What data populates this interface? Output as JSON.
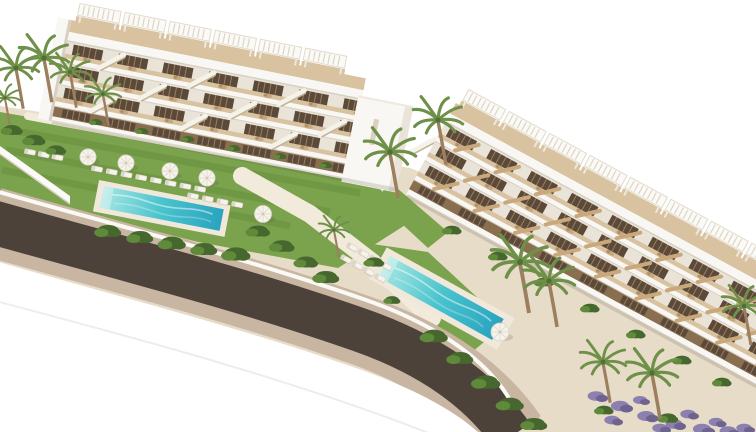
{
  "scene": {
    "description": "Aerial 3D architectural render of a white terraced apartment complex with rooftop pergolas, two turquoise pools, lawns with sun loungers and parasols, palm trees and a curved road in the foreground",
    "background": "white sky",
    "buildings": [
      {
        "name": "left-wing",
        "features": [
          "rooftop-pergolas",
          "stepped-terraces",
          "stairs",
          "round-daybeds",
          "end-tower"
        ]
      },
      {
        "name": "right-wing",
        "features": [
          "rooftop-pergolas",
          "stepped-units-descending-right",
          "wood-ladder-stairs",
          "round-daybeds"
        ]
      }
    ],
    "pools": [
      {
        "name": "main-pool",
        "shape": "long-rectangle"
      },
      {
        "name": "second-pool",
        "shape": "long-rectangle"
      }
    ],
    "road": {
      "name": "curved-asphalt-road",
      "edges": "beige-sidewalks"
    },
    "vegetation": [
      "palm-trees",
      "hedges",
      "lawns",
      "lavender-beds"
    ],
    "furniture": [
      "white-sun-loungers",
      "white-parasols",
      "tan-round-daybeds"
    ]
  },
  "palette": {
    "sky": "#ffffff",
    "building_white": "#f9f7f3",
    "building_shadow": "#e9e3d8",
    "building_edge": "#d7d0c2",
    "deck_wood": "#d8c2a0",
    "opening_dark": "#5b4a3a",
    "door_wood": "#8a6e50",
    "grass": "#7ba24c",
    "grass_dark": "#5e8a3a",
    "shrub": "#46682f",
    "lavender": "#8c80b0",
    "pool_shallow": "#a5e6e2",
    "pool_mid": "#49c3cd",
    "pool_deep": "#2aa4bf",
    "pool_deck": "#f0e9db",
    "terrain": "#e7dcc8",
    "path_light": "#f2ebdc",
    "road_asphalt": "#4c423a",
    "road_sidewalk": "#c8b5a2",
    "palm_frond": "#6f9049",
    "palm_trunk": "#9c7f5f",
    "white_furniture": "#f6f3ec",
    "sunbed": "#c7a77e"
  }
}
